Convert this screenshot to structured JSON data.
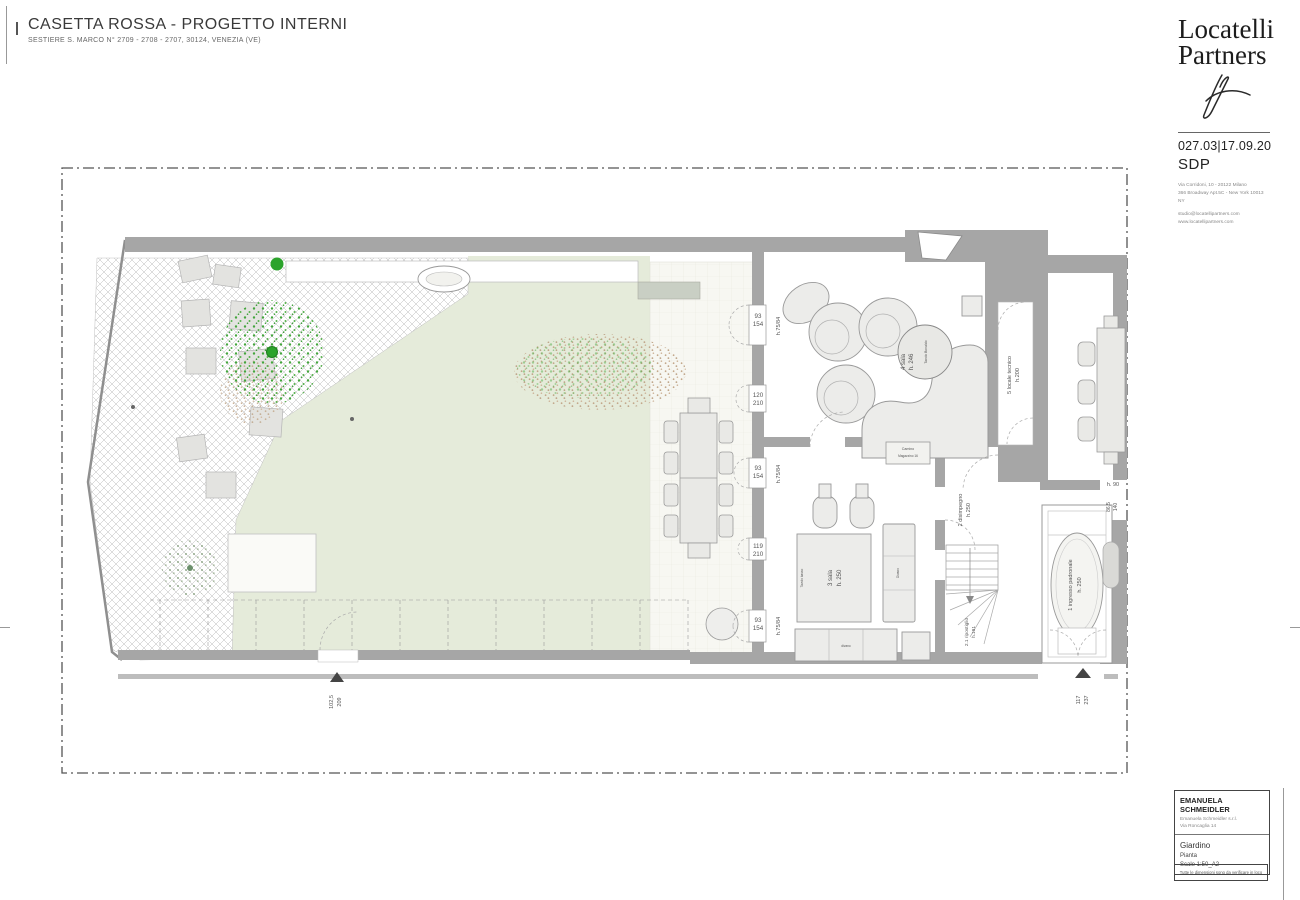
{
  "header": {
    "title": "CASETTA ROSSA - PROGETTO INTERNI",
    "subtitle": "SESTIERE S. MARCO N° 2709 - 2708 - 2707, 30124, VENEZIA (VE)"
  },
  "logo": {
    "name1": "Locatelli",
    "name2": "Partners",
    "code": "027.03|17.09.20",
    "sigla": "SDP",
    "address_milan": "Via Corridoni, 10 - 20122 Milano",
    "address_ny": "366 Broadway Apt.5C - New York  10013 NY",
    "email": "studio@locatellipartners.com",
    "website": "www.locatellipartners.com"
  },
  "titleblock": {
    "client": "EMANUELA SCHMEIDLER",
    "company": "Emanuela Schmeidler s.r.l.",
    "address": "Via Roncaglia 14",
    "project": "Giardino",
    "sheet": "Pianta",
    "scale": "Scale 1:50_A2",
    "note": "Tutte le dimensioni sono da verificare in loco"
  },
  "plan": {
    "rooms": {
      "sala4": "4 sala",
      "sala4_h": "h. 246",
      "sala3": "3 sala",
      "sala3_h": "h. 250",
      "locale5": "5 locale tecnico",
      "locale5_h": "h.200",
      "disimpegno2": "2 disimpegno",
      "disimpegno2_h": "h.250",
      "ripostiglio21": "2.1 ripostiglio",
      "ripostiglio21_h": "h.191",
      "ingresso1": "1 ingresso padronale",
      "ingresso1_h": "h. 250"
    },
    "furniture": {
      "round_table": "Tavolo Bonaldo",
      "coffee_table": "Tavolo basso",
      "sofa": "Divano",
      "sofa_low": "divano",
      "fireplace_l1": "Camino",
      "fireplace_l2": "Magazzino 16"
    },
    "dims": {
      "win_w": "93",
      "win_h": "154",
      "door1_w": "120",
      "door1_h": "210",
      "door2_w": "119",
      "door2_h": "210",
      "sill": "h.75/84",
      "gate_w": "102,5",
      "gate_h": "209",
      "entry_w": "117",
      "entry_h": "237",
      "h90": "h. 90",
      "side_w": "86,5",
      "side_h": "140"
    },
    "colors": {
      "wall_gray": "#a6a6a6",
      "lawn_green": "#e5ebda",
      "accent_green": "#2ca32c",
      "furniture_fill": "#ececea",
      "boundary": "#555555"
    }
  }
}
